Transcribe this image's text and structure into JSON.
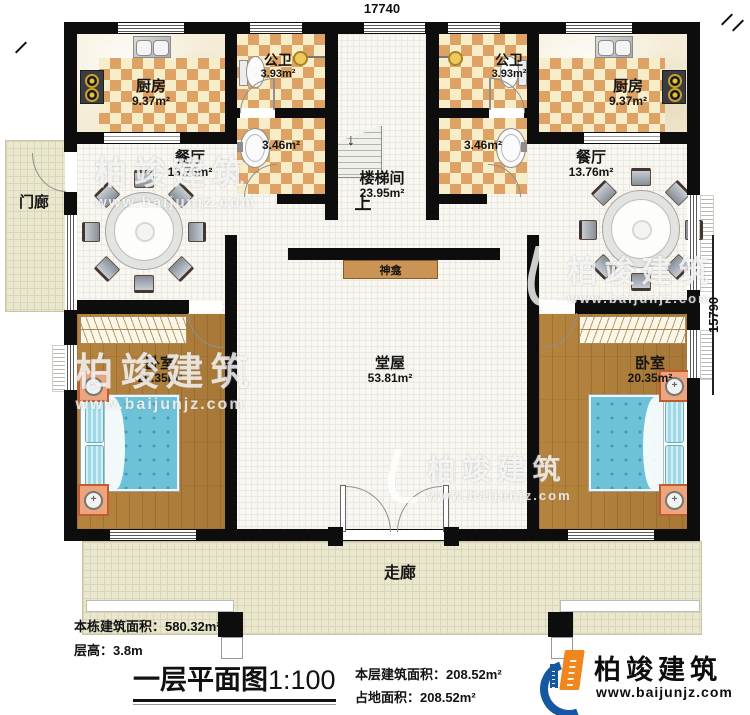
{
  "dimensions": {
    "width_top": "17740",
    "height_right": "15790"
  },
  "rooms": {
    "kitchen_left": {
      "name": "厨房",
      "area": "9.37m²"
    },
    "kitchen_right": {
      "name": "厨房",
      "area": "9.37m²"
    },
    "bath_left": {
      "name": "公卫",
      "area": "3.93m²"
    },
    "bath_right": {
      "name": "公卫",
      "area": "3.93m²"
    },
    "wash_left": {
      "area": "3.46m²"
    },
    "wash_right": {
      "area": "3.46m²"
    },
    "dining_left": {
      "name": "餐厅",
      "area": "13.76m²"
    },
    "dining_right": {
      "name": "餐厅",
      "area": "13.76m²"
    },
    "stairwell": {
      "name": "楼梯间",
      "area": "23.95m²",
      "up": "上"
    },
    "hall": {
      "name": "堂屋",
      "area": "53.81m²"
    },
    "shrine": {
      "name": "神龛"
    },
    "bedroom_left": {
      "name": "卧室",
      "area": "20.35m²"
    },
    "bedroom_right": {
      "name": "卧室",
      "area": "20.35m²"
    },
    "porch": {
      "name": "门廊"
    },
    "corridor": {
      "name": "走廊"
    }
  },
  "footer": {
    "building_total_area_label": "本栋建筑面积：",
    "building_total_area_value": "580.32m²",
    "floor_height_label": "层高：",
    "floor_height_value": "3.8m",
    "plan_title": "一层平面图",
    "plan_scale": "1:100",
    "floor_area_label": "本层建筑面积：",
    "floor_area_value": "208.52m²",
    "land_area_label": "占地面积：",
    "land_area_value": "208.52m²"
  },
  "logo": {
    "brand": "柏竣建筑",
    "website": "www.baijunjz.com"
  },
  "watermark": {
    "brand": "柏竣建筑",
    "website": "www.baijunjz.com"
  },
  "colors": {
    "wall": "#0d0d0d",
    "tile_orange": "#dfa265",
    "tile_cream": "#f8edc9",
    "wood": "#b08040",
    "bed_blue": "#6ec2d8",
    "floor_beige": "#eae7cf",
    "shrine_tan": "#c99455",
    "logo_blue": "#17579f",
    "logo_orange": "#f0861e"
  }
}
